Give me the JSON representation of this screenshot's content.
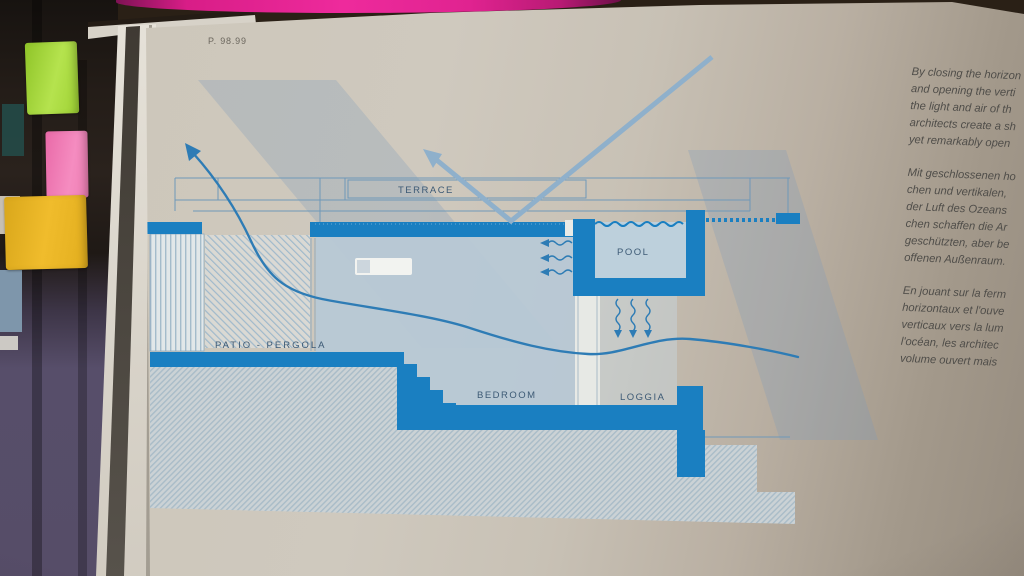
{
  "page_ref": "P. 98.99",
  "diagram": {
    "labels": {
      "terrace": "TERRACE",
      "pool": "POOL",
      "patio": "PATIO - PERGOLA",
      "bedroom": "BEDROOM",
      "loggia": "LOGGIA"
    },
    "colors": {
      "solid_blue": "#1a7fc1",
      "room_fill": "#b7c9d6",
      "pool_water": "#bdd0dc",
      "thin_line": "#6f98b8",
      "label_text": "#3d5a75",
      "sun_band": "rgba(127,156,186,0.28)",
      "arrow_ray": "#8fb0cb",
      "arrow_wind": "#2e7cb5"
    },
    "icons": [
      "sun-reflection-arrow",
      "airflow-arrow",
      "evaporation-squiggle-down",
      "breeze-squiggle-left",
      "water-wave-line"
    ]
  },
  "text_columns": {
    "english": [
      "By closing the horizon",
      "and opening the verti",
      "the light and air of th",
      "architects create a sh",
      "yet remarkably open"
    ],
    "german": [
      "Mit geschlossenen ho",
      "chen und vertikalen,",
      "der Luft des Ozeans",
      "chen schaffen die Ar",
      "geschützten, aber be",
      "offenen Außenraum."
    ],
    "french": [
      "En jouant sur la ferm",
      "horizontaux et l'ouve",
      "verticaux vers la lum",
      "l'océan, les architec",
      "volume ouvert mais"
    ]
  },
  "photo_context": {
    "sticky_tabs": [
      {
        "name": "green-tab",
        "color": "#a8d435"
      },
      {
        "name": "pink-tab",
        "color": "#f07ab4"
      },
      {
        "name": "yellow-tab",
        "color": "#e7b121"
      }
    ],
    "page_top_stripe_color": "#dd2090"
  }
}
